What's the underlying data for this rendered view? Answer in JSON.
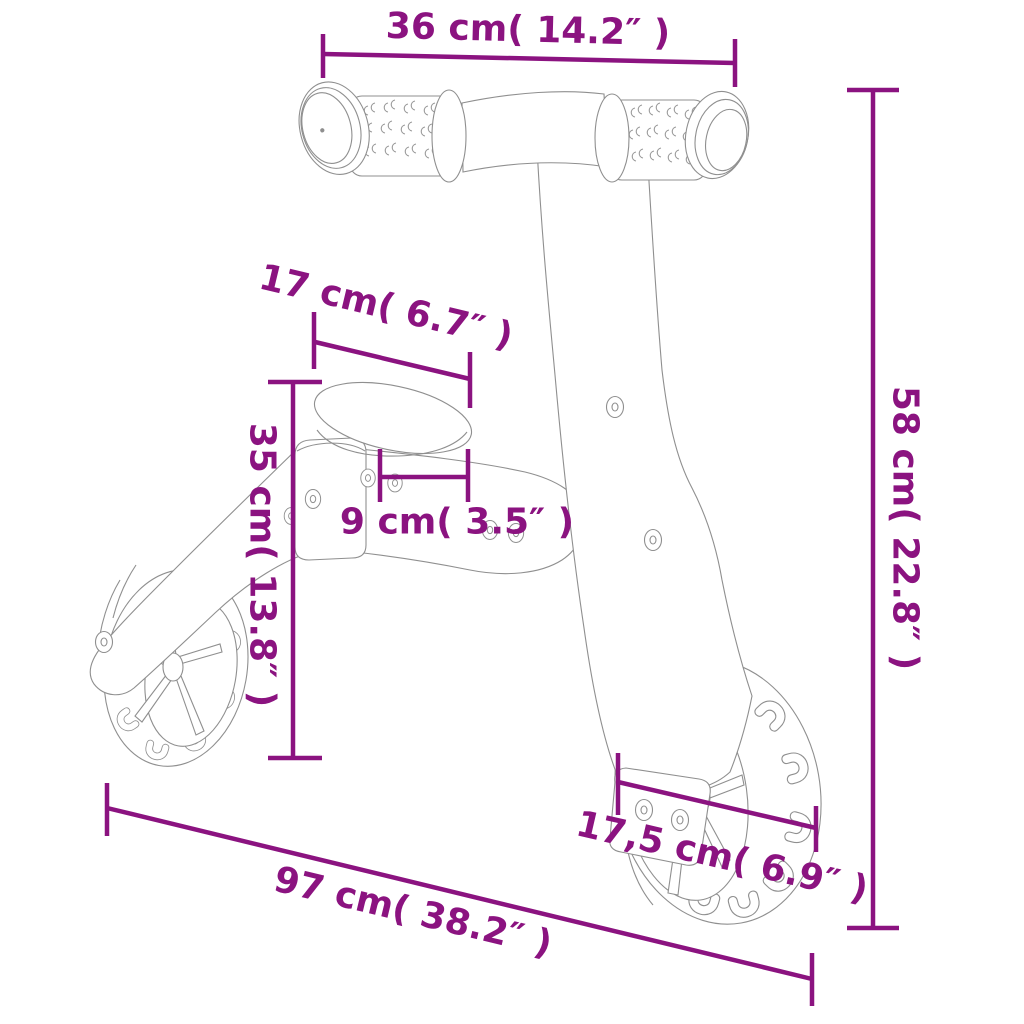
{
  "diagram": {
    "kind": "product dimension line drawing",
    "accent_color": "#8B1380",
    "drawing_line_color": "#8f8f8f",
    "background_color": "#ffffff"
  },
  "dimensions": {
    "handlebar_width": {
      "label": "36 cm( 14.2″ )"
    },
    "overall_height": {
      "label": "58 cm( 22.8″ )"
    },
    "seat_length": {
      "label": "17 cm( 6.7″ )"
    },
    "seat_height": {
      "label": "35 cm( 13.8″ )"
    },
    "seat_width": {
      "label": "9 cm( 3.5″ )"
    },
    "overall_length": {
      "label": "97 cm( 38.2″ )"
    },
    "wheel_diameter": {
      "label": "17,5 cm( 6.9″ )"
    }
  }
}
